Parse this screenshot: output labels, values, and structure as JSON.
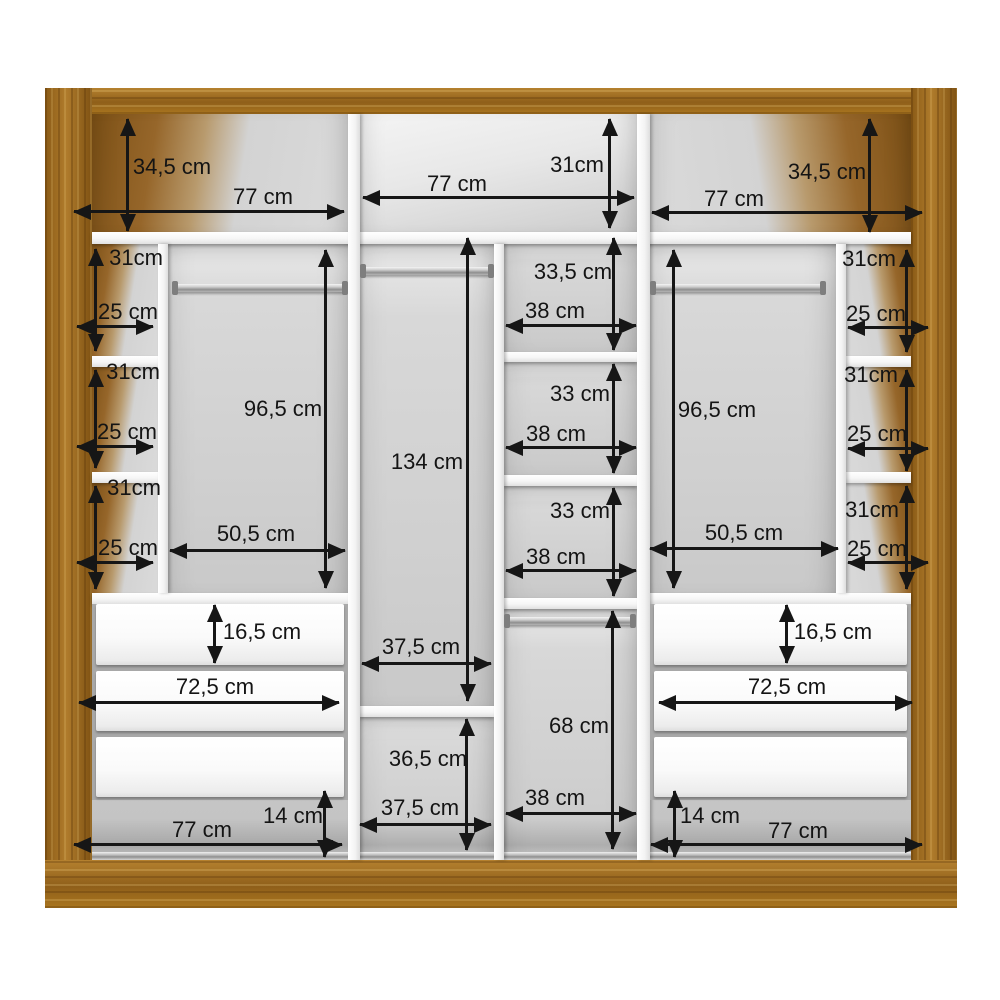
{
  "wardrobe": {
    "top_row": {
      "left": {
        "height": "34,5 cm",
        "width": "77 cm"
      },
      "middle": {
        "height": "31cm",
        "width": "77 cm"
      },
      "right": {
        "height": "34,5 cm",
        "width": "77 cm"
      }
    },
    "left_shelf_column": {
      "cells": [
        {
          "height": "31cm",
          "width": "25 cm"
        },
        {
          "height": "31cm",
          "width": "25 cm"
        },
        {
          "height": "31cm",
          "width": "25 cm"
        }
      ]
    },
    "right_shelf_column": {
      "cells": [
        {
          "height": "31cm",
          "width": "25 cm"
        },
        {
          "height": "31cm",
          "width": "25 cm"
        },
        {
          "height": "31cm",
          "width": "25 cm"
        }
      ]
    },
    "left_hanging_section": {
      "height": "96,5 cm",
      "width": "50,5 cm"
    },
    "right_hanging_section": {
      "height": "96,5 cm",
      "width": "50,5 cm"
    },
    "middle_tall_section": {
      "height": "134 cm",
      "width": "37,5 cm"
    },
    "middle_lower_shelf": {
      "height": "36,5 cm",
      "width": "37,5 cm"
    },
    "center_shelf_column": {
      "cells": [
        {
          "height": "33,5 cm",
          "width": "38 cm"
        },
        {
          "height": "33 cm",
          "width": "38 cm"
        },
        {
          "height": "33 cm",
          "width": "38 cm"
        }
      ],
      "hanging": {
        "height": "68 cm",
        "width": "38 cm"
      }
    },
    "left_drawers": {
      "drawer_height": "16,5 cm",
      "drawer_width": "72,5 cm",
      "base_height": "14 cm",
      "base_width": "77 cm"
    },
    "right_drawers": {
      "drawer_height": "16,5 cm",
      "drawer_width": "72,5 cm",
      "base_height": "14 cm",
      "base_width": "77 cm"
    }
  },
  "colors": {
    "wood": "#9a6a1e",
    "interior_gray": "#d2d2d2",
    "panel_white": "#fbfbfb",
    "dimension_black": "#161616"
  }
}
